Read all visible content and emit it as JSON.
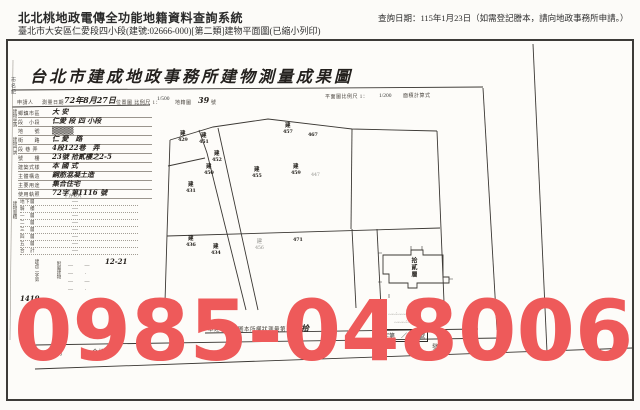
{
  "colors": {
    "overlay_red": "#ee5a5a",
    "ink": "#2e2b28",
    "paper": "#fdfcf9"
  },
  "header": {
    "system_title": "北北桃地政電傳全功能地籍資料查詢系統",
    "query_date": "查詢日期：115年1月23日（如需登記謄本，請向地政事務所申請。）",
    "subtitle": "臺北市大安區仁愛段四小段(建號:02666-000)[第二類]建物平面圖(已縮小列印)"
  },
  "form": {
    "title": "台北市建成地政事務所建物測量成果圖",
    "margin_note": "市名紀",
    "top_row": {
      "applicant": "申請人",
      "survey_date_label": "測量日期",
      "survey_date": "72年8月27日",
      "loc_scale_label": "位置圖 比例尺 1：",
      "loc_scale_frac": "1/500",
      "cad_label": "地籍圖",
      "cad_no": "39",
      "cad_unit": "號",
      "plan_scale_label": "平面圖比例尺 1：",
      "plan_scale_frac": "1/200",
      "area_calc_label": "面積計算式"
    },
    "left_table": {
      "group_location": "建物坐落",
      "group_door": "建物門牌",
      "group_area": "建物面積",
      "area_unit": "平方公尺",
      "rows": [
        {
          "label": "鄉鎮市區",
          "value": "大 安"
        },
        {
          "label": "段　小段",
          "value": "仁愛 段 四 小段"
        },
        {
          "label": "地　　號",
          "value": "▒▒▒▒"
        },
        {
          "label": "街　　路",
          "value": "仁 愛　路"
        },
        {
          "label": "段 巷 弄",
          "value": "4段122巷　弄"
        },
        {
          "label": "號　　樓",
          "value": "23號 拾貳樓之2-5"
        },
        {
          "label": "建築式樣",
          "value": "本 國 式"
        },
        {
          "label": "主體構造",
          "value": "鋼筋混凝土造"
        },
        {
          "label": "主要用途",
          "value": "集合住宅"
        },
        {
          "label": "使用執照",
          "value": "72字 第1116 號"
        }
      ],
      "area_rows": [
        {
          "label": "地下層",
          "value": "—"
        },
        {
          "label": "騎　樓",
          "value": "—"
        },
        {
          "label": "一　層",
          "value": "—"
        },
        {
          "label": "二　層",
          "value": "—"
        },
        {
          "label": "三　層",
          "value": "—"
        },
        {
          "label": "四　層",
          "value": "—"
        },
        {
          "label": "五　層",
          "value": "—"
        },
        {
          "label": "合　計",
          "value": "—"
        }
      ],
      "attach_label": "附屬建物",
      "attach_rows": [
        "—　　—",
        "—　　·",
        "—　　—",
        "—　　·"
      ],
      "file_no_vertical": "建改二字第",
      "file_no": "1419",
      "file_no_unit": "號",
      "hand_note": "12-21"
    },
    "map": {
      "parcels": [
        {
          "t": "建",
          "n": "429"
        },
        {
          "t": "建",
          "n": "451"
        },
        {
          "t": "建",
          "n": "452"
        },
        {
          "t": "建",
          "n": "450"
        },
        {
          "t": "建",
          "n": "431"
        },
        {
          "t": "建",
          "n": "455"
        },
        {
          "t": "建",
          "n": "459"
        },
        {
          "t": "建",
          "n": "457"
        },
        {
          "t": "",
          "n": "467"
        },
        {
          "t": "",
          "n": "447"
        },
        {
          "t": "建",
          "n": "436"
        },
        {
          "t": "建",
          "n": "434"
        },
        {
          "t": "建",
          "n": "456"
        },
        {
          "t": "",
          "n": "471"
        }
      ],
      "floorplan_label": "拾貳層"
    },
    "bottom": {
      "row1_text": "本建物平面圖本所權狀測量第",
      "row1_big": "拾",
      "stamp_box": "字第　／／　號",
      "row2_items": [
        "成",
        "列",
        "合格",
        "發狀"
      ],
      "hand_calc1": "﹏﹏·﹏﹏﹏＝﹏﹏",
      "hand_calc2": "﹏﹏﹏·﹏"
    }
  },
  "overlay": {
    "phone": "0985-048006"
  }
}
